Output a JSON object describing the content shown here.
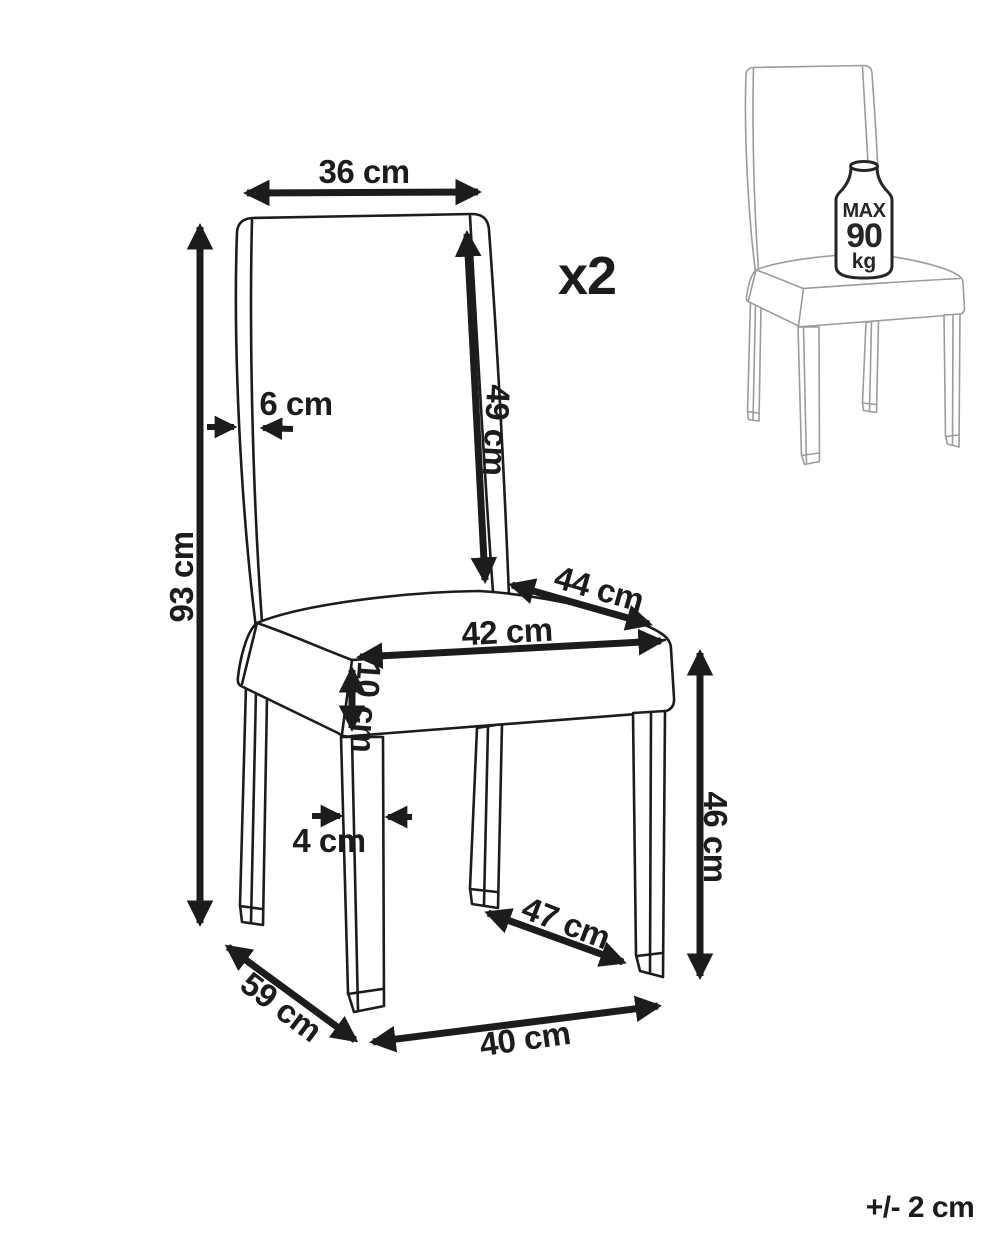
{
  "colors": {
    "ink": "#1c1c1c",
    "sketch": "#9b9b9b",
    "background": "#ffffff"
  },
  "product": {
    "quantity": "x2",
    "tolerance": "+/- 2 cm",
    "max_load": {
      "label": "MAX",
      "value": "90",
      "unit": "kg"
    }
  },
  "dimensions": {
    "back_width": "36 cm",
    "back_thickness": "6 cm",
    "backrest_height": "49 cm",
    "total_height": "93 cm",
    "seat_depth": "44 cm",
    "seat_width": "42 cm",
    "seat_thickness": "10 cm",
    "leg_thickness": "4 cm",
    "seat_height": "46 cm",
    "leg_span_depth": "47 cm",
    "base_depth": "59 cm",
    "base_width": "40 cm"
  }
}
